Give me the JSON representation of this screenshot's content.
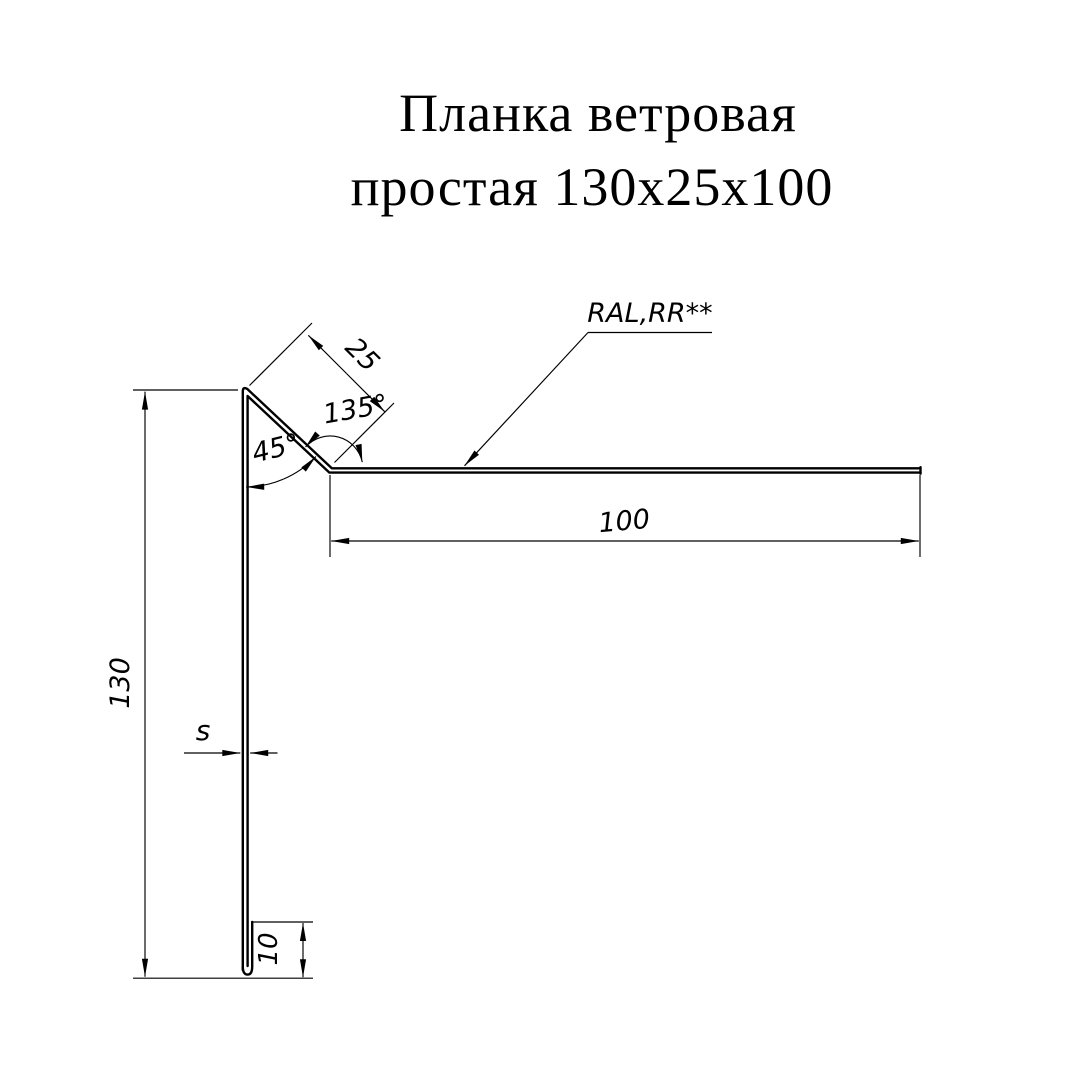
{
  "title": {
    "line1": "Планка ветровая",
    "line2": "простая 130х25х100"
  },
  "annotations": {
    "coating_label": "RAL,RR**",
    "dim_diagonal_flange": "25",
    "angle_bend": "135°",
    "angle_top": "45°",
    "dim_horizontal_flange": "100",
    "dim_vertical_flange": "130",
    "thickness_label": "s",
    "dim_bottom_hem": "10"
  },
  "colors": {
    "ink": "#000000",
    "background": "#ffffff"
  }
}
